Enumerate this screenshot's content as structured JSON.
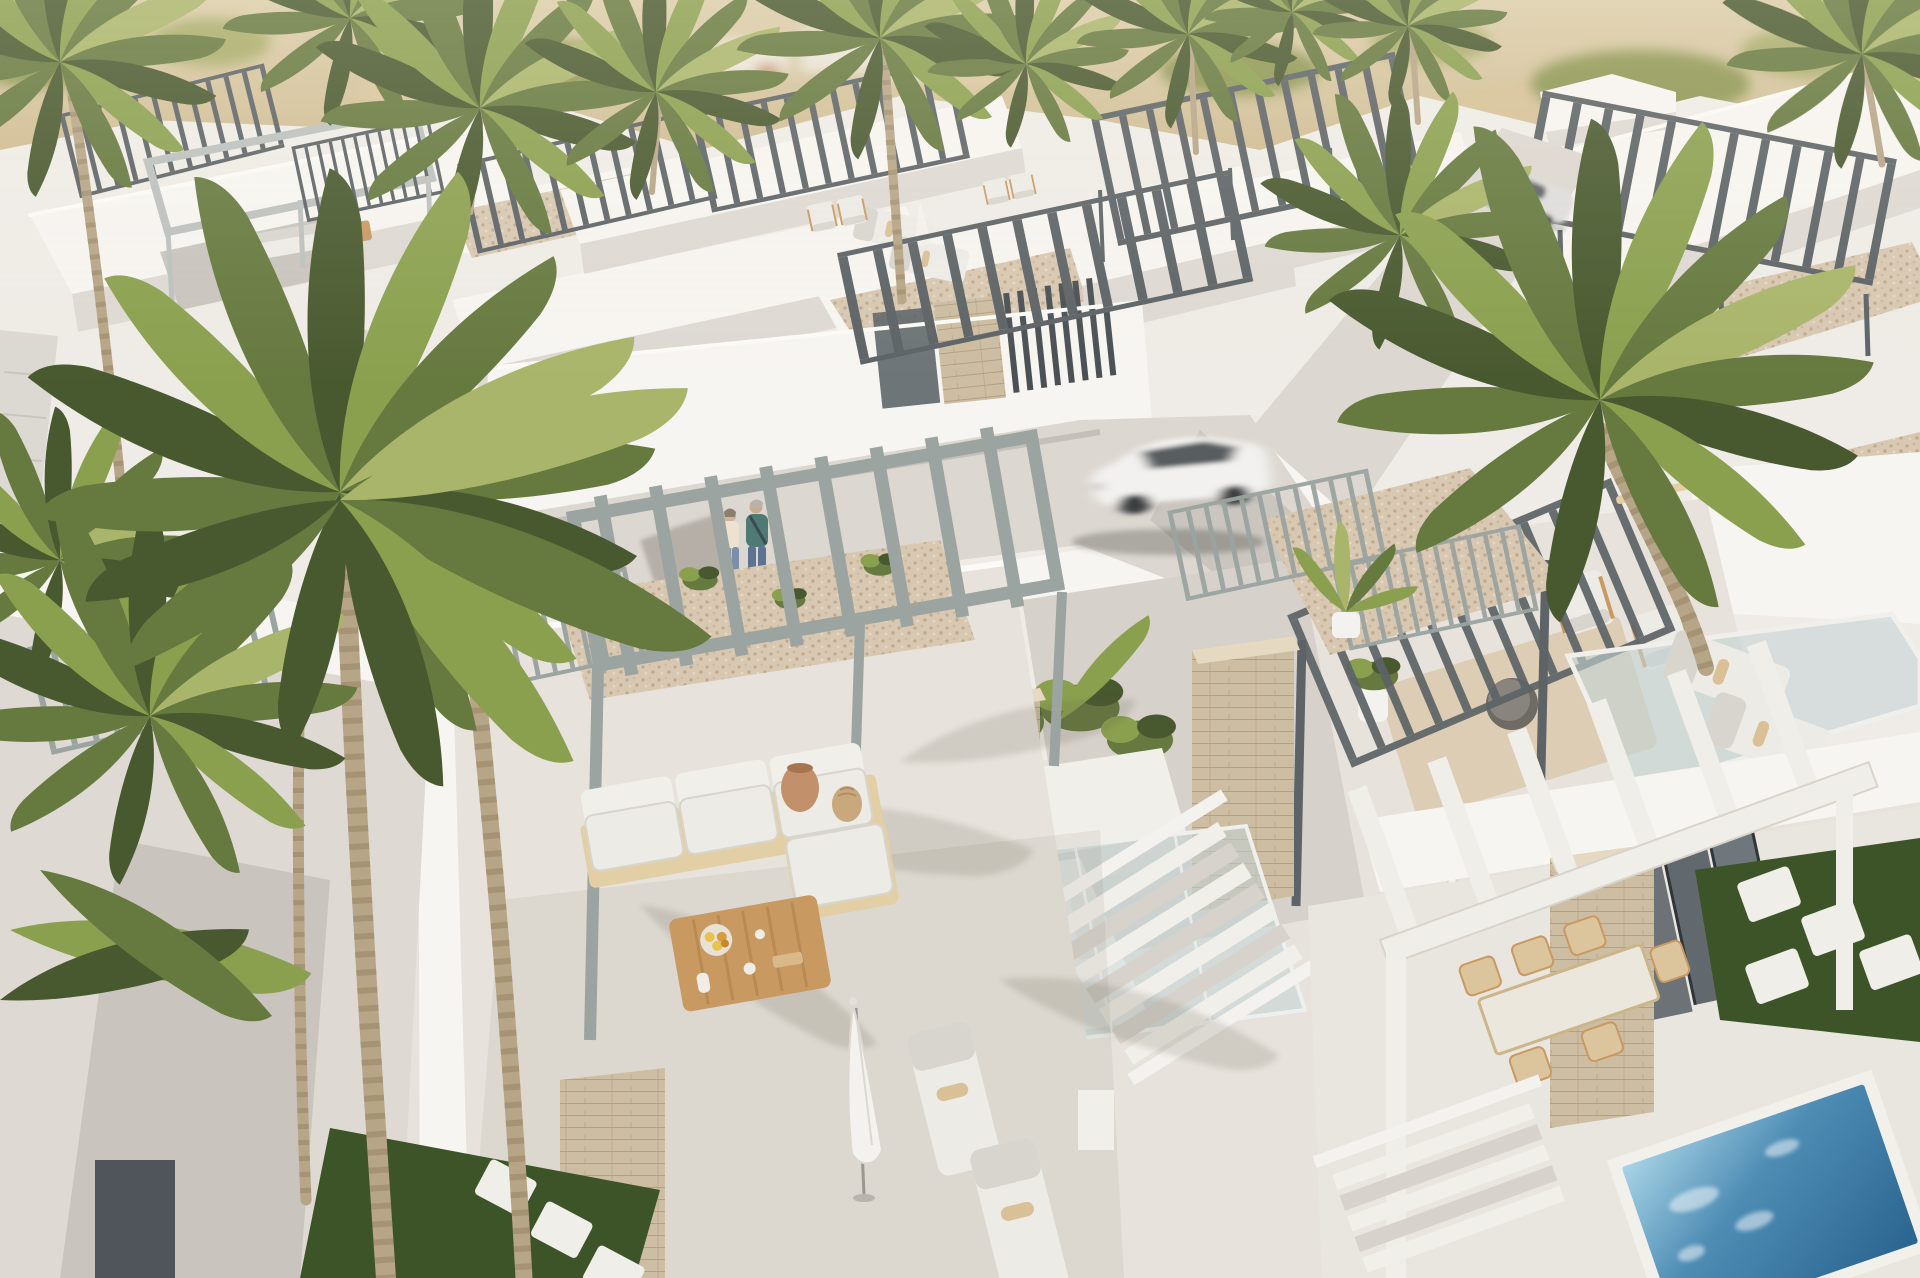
{
  "scene": {
    "type": "architectural-aerial-render",
    "description": "Sunny aerial 3D rendering of a modern white villa development with rooftop pergola terraces, palm trees, a street with a moving white SUV, a parked silver car, two pedestrians, outdoor furniture and a small blue plunge pool",
    "lighting": "bright midday sun, warm haze over sandy hills"
  },
  "palette": {
    "bg_hill_1": "#dbcda9",
    "bg_hill_2": "#c9b287",
    "bg_green": "#8e9752",
    "bg_green_2": "#a9ac6b",
    "wall_lit": "#f7f5f1",
    "wall_light": "#efece7",
    "wall_mid": "#ded9d3",
    "wall_shad": "#c9c4be",
    "wall_dark": "#b5b0aa",
    "floor": "#e7e3dc",
    "road": "#dcd7d0",
    "gravel": "#d8c8b2",
    "gravel_dot": "#bfa98e",
    "stone": "#cdbda2",
    "stone_line": "#b2a082",
    "pergola_dark": "#5d6366",
    "pergola_sage": "#9ba4a1",
    "pergola_light": "#bcc1be",
    "pergola_white": "#f0eee9",
    "wood": "#c89a62",
    "wood_light": "#e3cfa6",
    "cushion": "#edebe6",
    "cushion_shad": "#d8d5cf",
    "palm_dark": "#49592f",
    "palm_mid": "#66793f",
    "palm_light": "#8ba04f",
    "palm_pale": "#a9b56a",
    "trunk": "#b7a587",
    "trunk_dark": "#93815f",
    "grass": "#3c5427",
    "grass_light": "#55702f",
    "glass": "#c5d3d6",
    "pool_light": "#a8d4e6",
    "pool_mid": "#4f8db5",
    "pool_deep": "#2a648f",
    "car_white": "#f2f1ef",
    "car_glass": "#3e4347",
    "silver": "#dedddc",
    "person_teal": "#4e7a74",
    "person_cream": "#ece2cf",
    "person_jeans": "#5d7391",
    "towel": "#d9c096",
    "shadow_col": "rgba(115,105,88,.30)"
  },
  "objects": {
    "background": "Blurred sandy hillside with scrub and distant houses",
    "villas": "White flat-roofed villas with slatted pergolas and gravel roofs",
    "street": "Concrete street winding between villa walls",
    "white_suv": "White SUV driving along the street (motion blurred)",
    "parked_car": "Silver car parked in upper driveway",
    "pedestrians": "Couple walking beside sunlit wall",
    "foreground_terrace": "Rooftop terrace with steel pergola, white sectional sofa, wooden coffee table, closed parasol and sun loungers",
    "lounge_terrace": "Patio with wooden sofa, two armchairs and round table on a rug",
    "planter": "White planter box with tropical plants",
    "stairs": "White outdoor staircase with railings",
    "skylight": "Glass skylight deck with two sun loungers",
    "dining_patio": "Dining patio under white pergola with table and chairs",
    "plunge_pool": "Small blue plunge pool",
    "garden_path": "Dark green lawn with white stepping stones",
    "palm_left": "Large multi-trunk palm in left foreground",
    "palm_right": "Tall palm on the right",
    "umbrellas": "Closed white patio umbrellas"
  }
}
